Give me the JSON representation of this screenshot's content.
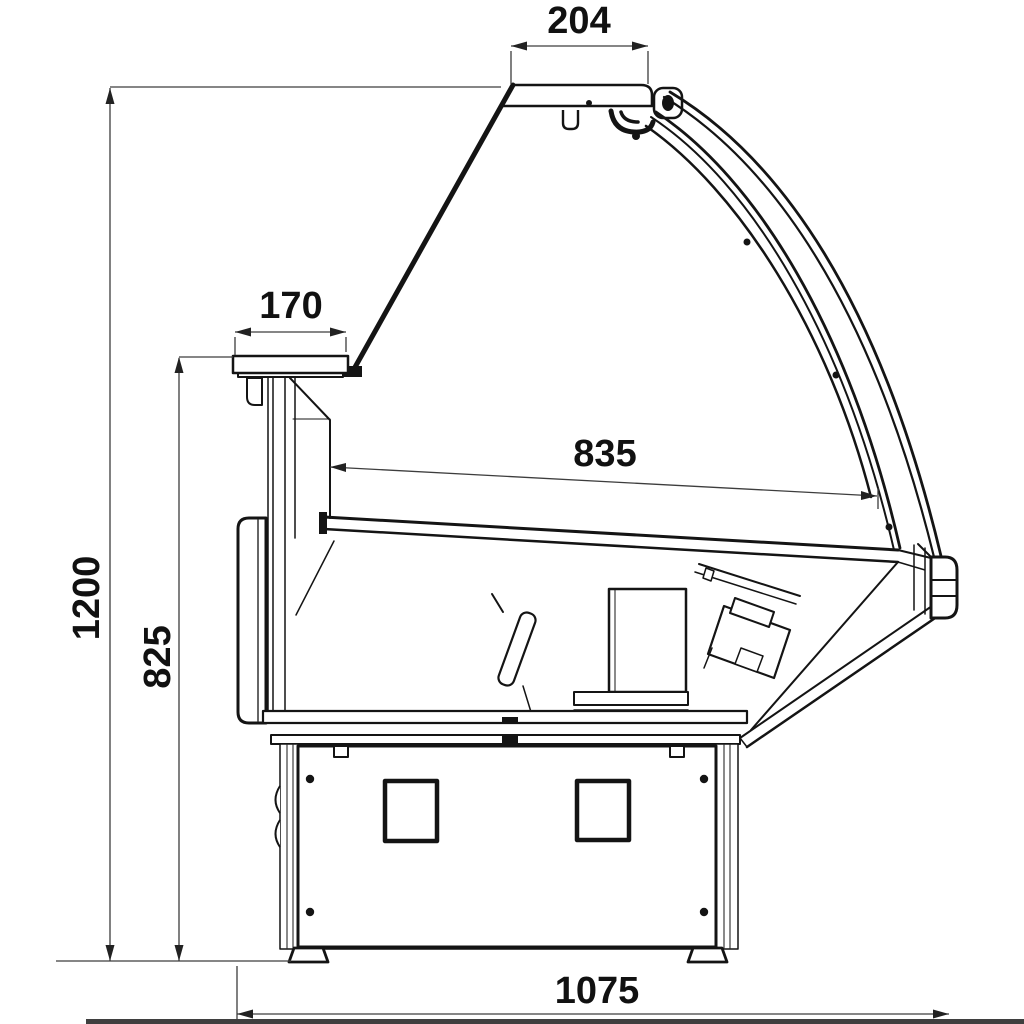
{
  "drawing": {
    "type": "technical dimension drawing",
    "subject": "serve-over refrigerated display counter - side cross-section",
    "dimensions": {
      "canopy_width": "204",
      "shelf_depth": "170",
      "deck_length": "835",
      "overall_height": "1200",
      "shelf_height": "825",
      "overall_depth": "1075"
    },
    "colors": {
      "line": "#141414",
      "dimension_line": "#3d3d3d",
      "label": "#111111",
      "background": "#ffffff",
      "bottom_bar": "#3f3f3f"
    }
  }
}
